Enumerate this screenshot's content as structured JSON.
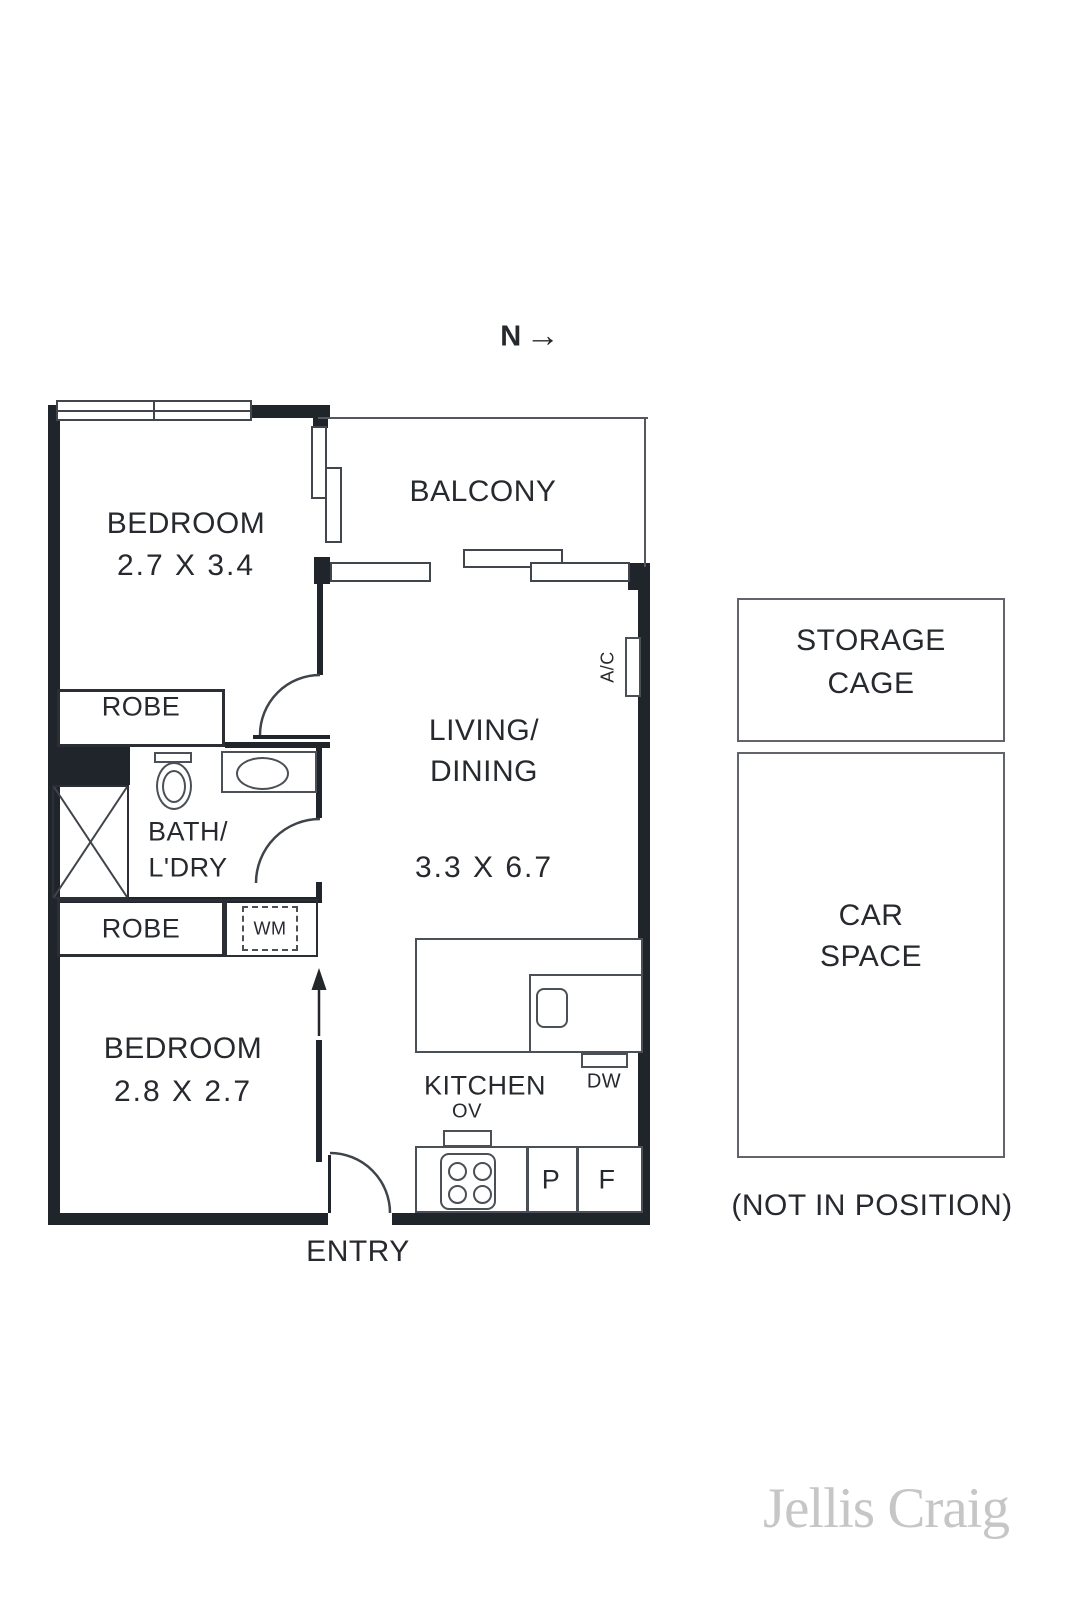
{
  "north": {
    "label": "N",
    "arrow": "→"
  },
  "rooms": {
    "bedroom1": {
      "name": "BEDROOM",
      "dims": "2.7 X 3.4"
    },
    "balcony": {
      "name": "BALCONY"
    },
    "living": {
      "line1": "LIVING/",
      "line2": "DINING",
      "dims": "3.3 X 6.7"
    },
    "robe_top": {
      "name": "ROBE"
    },
    "bath": {
      "line1": "BATH/",
      "line2": "L'DRY"
    },
    "robe_bottom": {
      "name": "ROBE"
    },
    "bedroom2": {
      "name": "BEDROOM",
      "dims": "2.8 X 2.7"
    },
    "kitchen": {
      "name": "KITCHEN"
    },
    "entry": {
      "name": "ENTRY"
    }
  },
  "appliances": {
    "wm": "WM",
    "ov": "OV",
    "dw": "DW",
    "pantry": "P",
    "fridge": "F",
    "ac": "A/C"
  },
  "outside": {
    "storage_line1": "STORAGE",
    "storage_line2": "CAGE",
    "car_line1": "CAR",
    "car_line2": "SPACE",
    "note": "(NOT IN POSITION)"
  },
  "branding": {
    "logo": "Jellis Craig"
  },
  "colors": {
    "wall": "#20252c",
    "fixture_line": "#4b5056",
    "text": "#26292e",
    "outside_border": "#61656b",
    "logo": "#c6c6c6"
  }
}
